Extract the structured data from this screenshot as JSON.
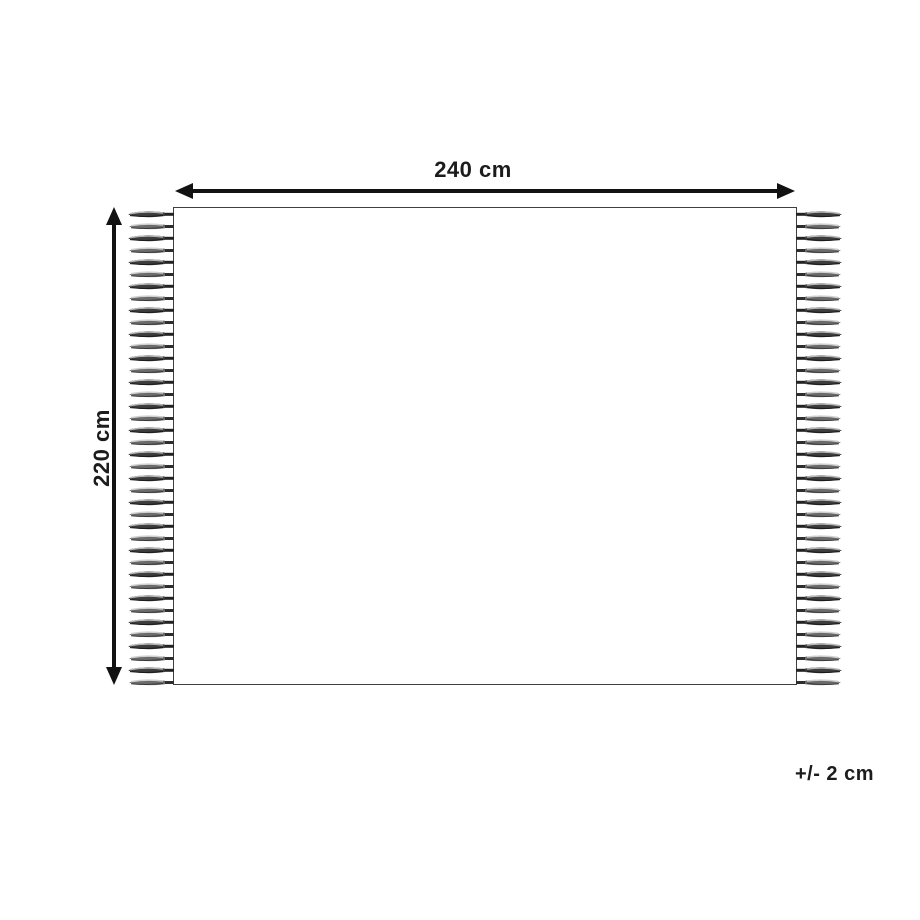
{
  "figure": {
    "type": "product-dimension-diagram",
    "subject": "rectangular rug with fringed left and right edges",
    "width_label": "240 cm",
    "height_label": "220 cm",
    "tolerance_label": "+/- 2 cm",
    "fringe": {
      "sides": [
        "left",
        "right"
      ],
      "tassels_per_side": 40
    },
    "colors": {
      "background": "#ffffff",
      "body_fill": "#ffffff",
      "outline": "#3f3f3f",
      "arrow": "#121212",
      "text": "#1c1c1c",
      "tassel_dark": "#3d3d3d",
      "tassel_mid": "#6b6b6b",
      "tassel_light": "#b5b5b5"
    }
  }
}
